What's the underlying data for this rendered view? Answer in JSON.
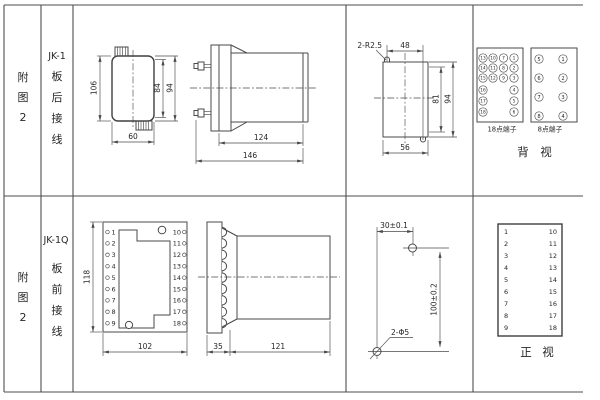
{
  "colors": {
    "line": "#4a4a4a",
    "text": "#262626",
    "background": "#ffffff"
  },
  "rows": {
    "top": {
      "figure": [
        "附",
        "图",
        "2"
      ],
      "model": "JK-1",
      "wiring": [
        "板",
        "后",
        "接",
        "线"
      ],
      "outline": {
        "h106": "106",
        "h84": "84",
        "h94": "94",
        "w60": "60"
      },
      "side": {
        "d124": "124",
        "d146": "146"
      },
      "cutout": {
        "r": "2-R2.5",
        "w48": "48",
        "h81": "81",
        "h94": "94",
        "w56": "56"
      },
      "rear": {
        "b18": {
          "label": "18点端子",
          "rows": [
            [
              "13",
              "10",
              "7",
              "1"
            ],
            [
              "14",
              "11",
              "8",
              "2"
            ],
            [
              "15",
              "12",
              "9",
              "3"
            ],
            [
              "16",
              "4"
            ],
            [
              "17",
              "5"
            ],
            [
              "18",
              "6"
            ]
          ]
        },
        "b8": {
          "label": "8点端子",
          "left": [
            "5",
            "6",
            "7",
            "8"
          ],
          "right": [
            "1",
            "2",
            "3",
            "4"
          ]
        },
        "caption": [
          "背",
          "视"
        ]
      }
    },
    "bottom": {
      "figure": [
        "附",
        "图",
        "2"
      ],
      "model": "JK-1Q",
      "wiring": [
        "板",
        "前",
        "接",
        "线"
      ],
      "front": {
        "h118": "118",
        "w102": "102",
        "left": [
          "1",
          "2",
          "3",
          "4",
          "5",
          "6",
          "7",
          "8",
          "9"
        ],
        "right": [
          "10",
          "11",
          "12",
          "13",
          "14",
          "15",
          "16",
          "17",
          "18"
        ]
      },
      "side": {
        "d35": "35",
        "d121": "121"
      },
      "drill": {
        "w30": "30±0.1",
        "h100": "100±0.2",
        "holes": "2-Φ5"
      },
      "table": {
        "left": [
          "1",
          "2",
          "3",
          "4",
          "5",
          "6",
          "7",
          "8",
          "9"
        ],
        "right": [
          "10",
          "11",
          "12",
          "13",
          "14",
          "15",
          "16",
          "17",
          "18"
        ],
        "caption": [
          "正",
          "视"
        ]
      }
    }
  }
}
